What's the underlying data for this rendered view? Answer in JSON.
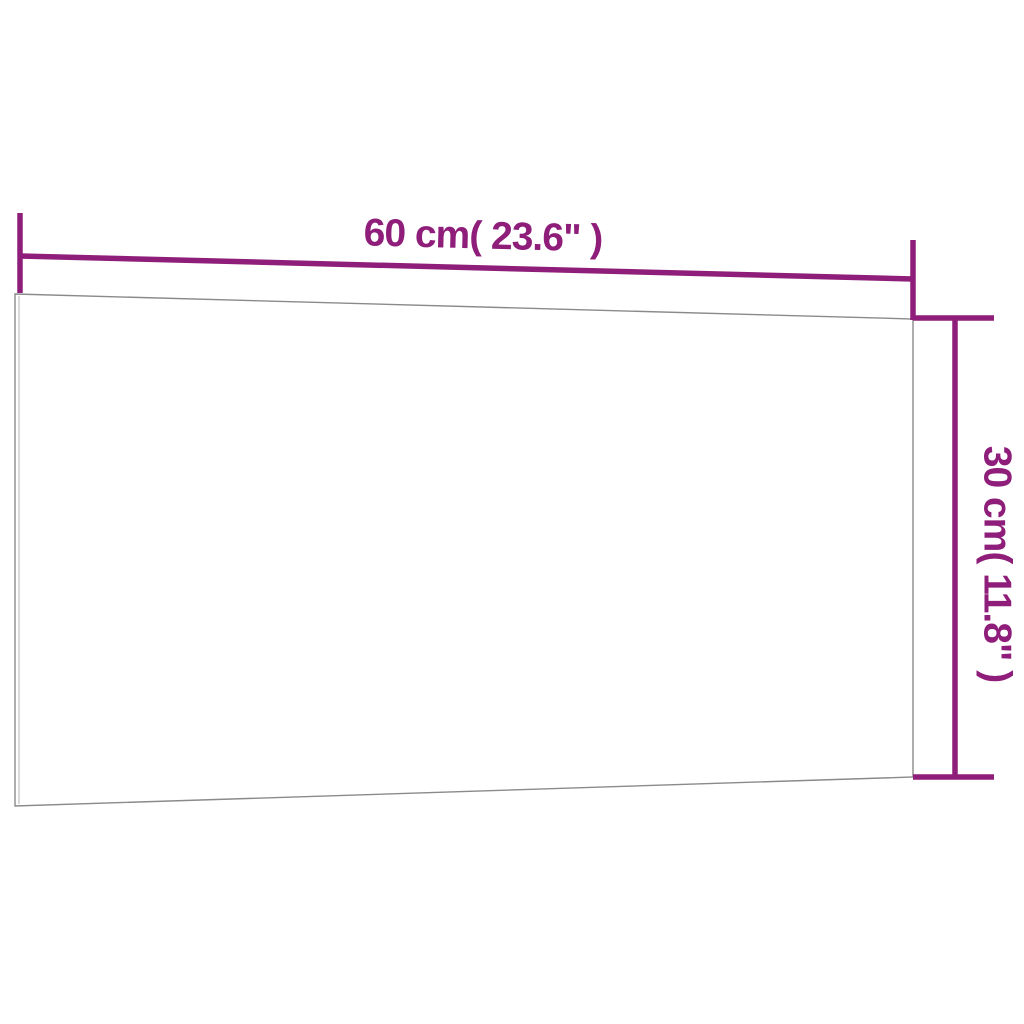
{
  "diagram": {
    "width_label": "60 cm( 23.6\" )",
    "height_label": "30 cm( 11.8\" )",
    "dimensions": {
      "width_cm": 60,
      "width_inches": 23.6,
      "height_cm": 30,
      "height_inches": 11.8
    }
  },
  "colors": {
    "dimension-color": "#8e1e79",
    "board-outline-color": "#8a8a8a",
    "board-inner-edge-color": "#b3b3b3",
    "background-color": "#ffffff"
  }
}
